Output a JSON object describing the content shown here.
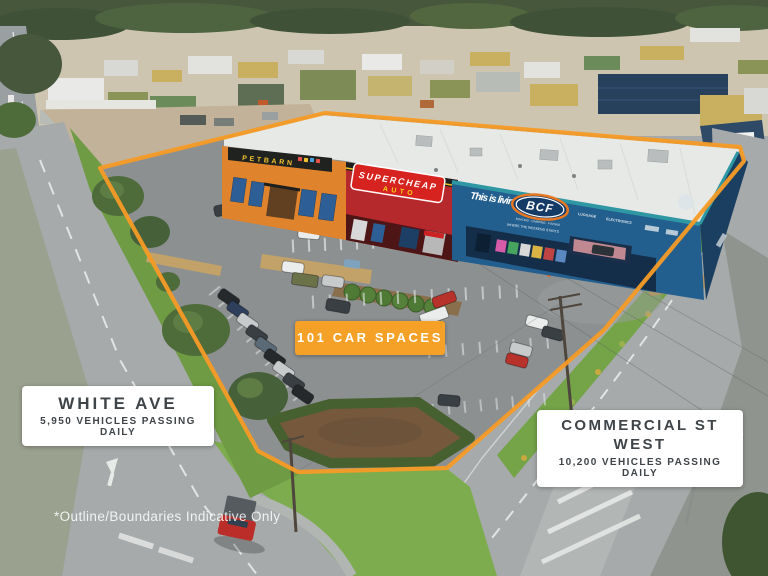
{
  "annotations": {
    "badge": "101 CAR SPACES",
    "street_left": {
      "name": "WHITE AVE",
      "traffic": "5,950 VEHICLES PASSING DAILY"
    },
    "street_right": {
      "name": "COMMERCIAL ST WEST",
      "traffic": "10,200 VEHICLES PASSING DAILY"
    },
    "disclaimer": "*Outline/Boundaries Indicative Only"
  },
  "signage": {
    "petbarn": "PETBARN",
    "supercheap_top": "SUPERCHEAP",
    "supercheap_bottom": "AUTO",
    "bcf_tagline": "This is living!",
    "bcf_logo": "BCF",
    "bcf_logo_sub": "BOATING · CAMPING · FISHING",
    "bcf_slogan": "WHERE THE WEEKEND STARTS",
    "bcf_dept_1": "LUGGAGE",
    "bcf_dept_2": "ELECTRONICS"
  },
  "colors": {
    "boundary_orange": "#F59B26",
    "badge_orange": "#F5A128",
    "label_text": "#3E4448",
    "petbarn_orange": "#E0832D",
    "supercheap_red": "#C0272D",
    "bcf_blue": "#235F8E",
    "grass_green": "#7DAC4E",
    "asphalt_grey": "#8D9091"
  }
}
